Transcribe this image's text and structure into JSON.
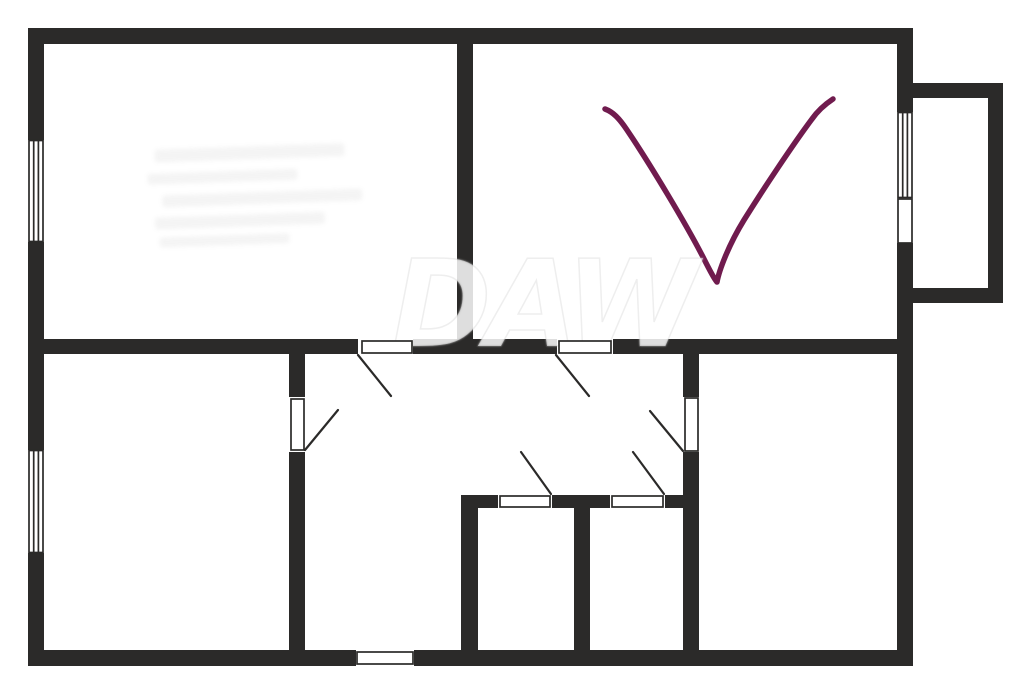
{
  "title": "apartment floor plan",
  "watermark": {
    "text": "DAW",
    "observed_gray_over_wall": "#a6a6a6"
  },
  "palette": {
    "wall": "#2b2a29",
    "background": "#ffffff",
    "door_leaf": "#ffffff",
    "checkmark": "#701b4e",
    "watermark_gray": "#a6a6a6"
  },
  "annotation": {
    "shape": "checkmark",
    "color": "#701b4e"
  },
  "features": {
    "rooms": 5,
    "windows": 3,
    "interior_doors": 6,
    "entrance_doors": 1,
    "balcony": true
  }
}
